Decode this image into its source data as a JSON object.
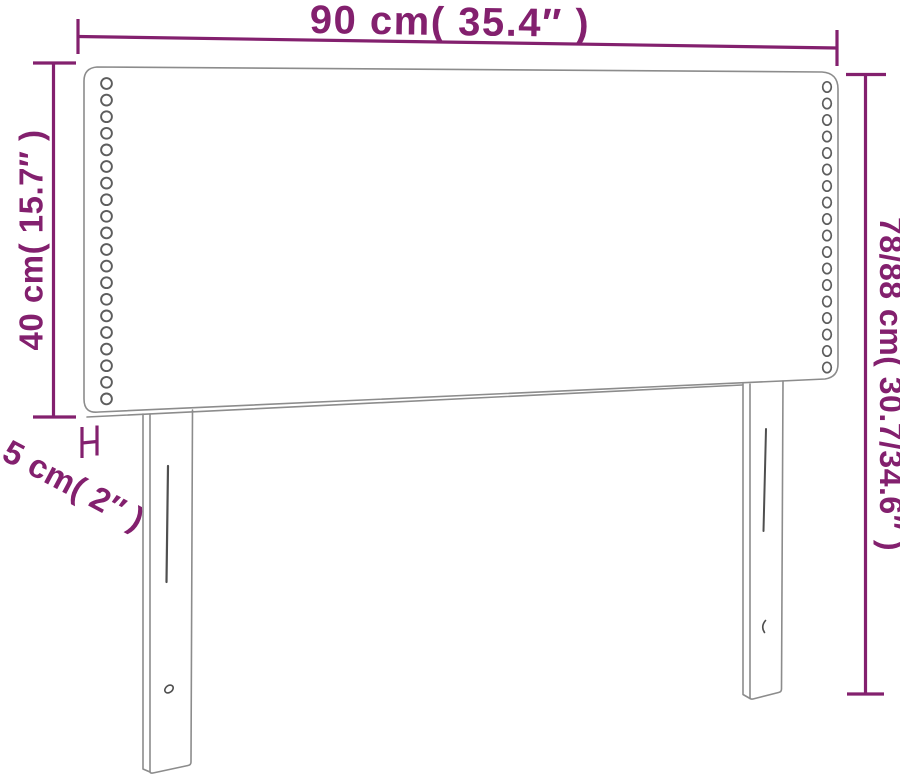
{
  "diagram": {
    "title": "Headboard dimension diagram",
    "accent_color": "#83206e",
    "outline_color": "#8c8c8c",
    "detail_color": "#4f4f4f",
    "stud_color": "#5d5d5d",
    "background_color": "#ffffff",
    "labels": {
      "width": "90 cm( 35.4″ )",
      "height_left": "40 cm( 15.7″ )",
      "height_right": "78/88 cm( 30.7/34.6″ )",
      "depth": "5 cm( 2″ )"
    },
    "studs": {
      "left": {
        "cx": 106.5,
        "cy_start": 83.5,
        "spacing": 16.6,
        "count": 20,
        "rx": 5.4,
        "ry": 5.4
      },
      "right": {
        "cx": 827,
        "cy_start": 87,
        "spacing": 16.5,
        "count": 18,
        "rx": 4.3,
        "ry": 5.2
      }
    }
  }
}
